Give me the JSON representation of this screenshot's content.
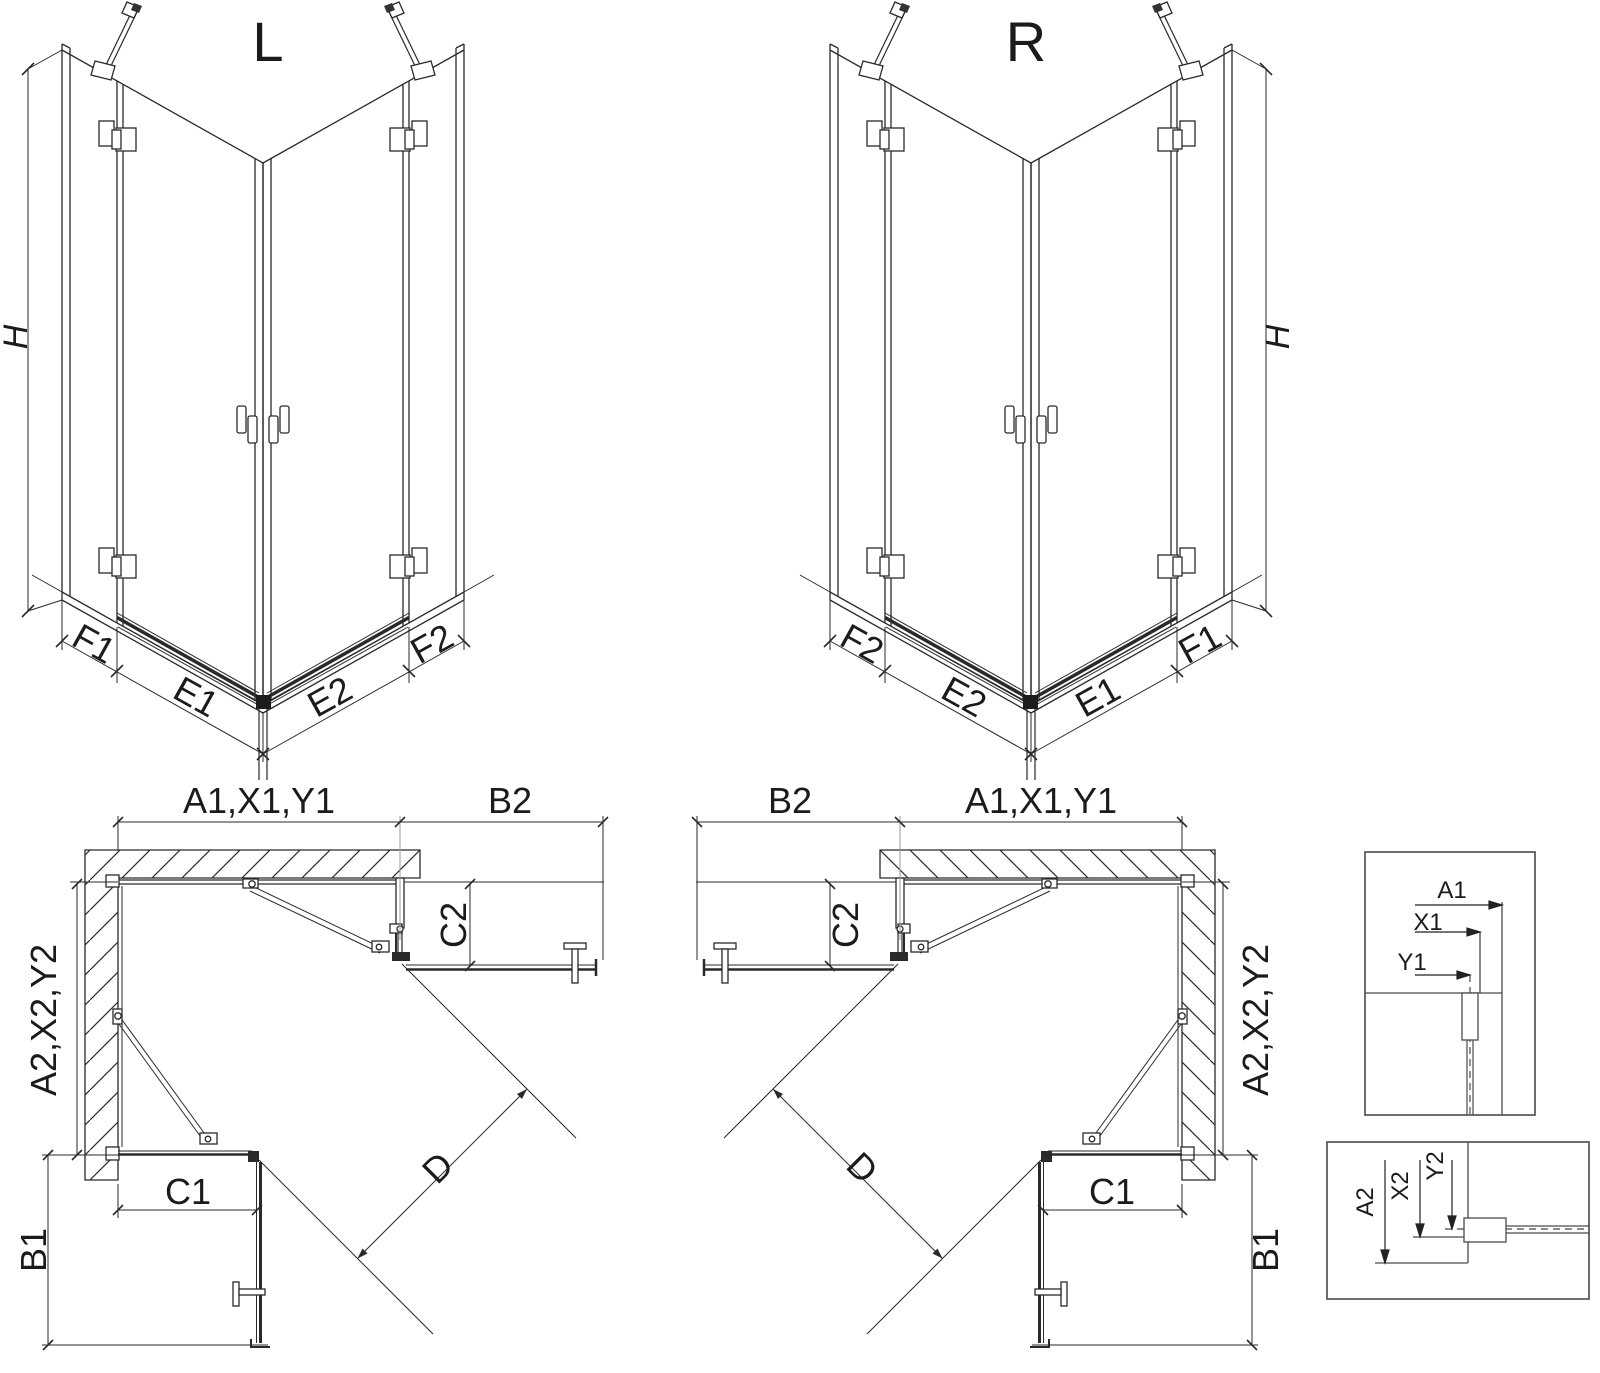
{
  "diagram": {
    "iso_left": {
      "title": "L",
      "h_label": "H",
      "f1": "F1",
      "e1": "E1",
      "e2": "E2",
      "f2": "F2"
    },
    "iso_right": {
      "title": "R",
      "h_label": "H",
      "f1": "F1",
      "e1": "E1",
      "e2": "E2",
      "f2": "F2"
    },
    "plan_left": {
      "top_width": "A1,X1,Y1",
      "door_width": "B2",
      "return_top": "C2",
      "side_depth": "A2,X2,Y2",
      "return_bottom": "C1",
      "door_depth": "B1",
      "diagonal": "D"
    },
    "plan_right": {
      "top_width": "A1,X1,Y1",
      "door_width": "B2",
      "return_top": "C2",
      "side_depth": "A2,X2,Y2",
      "return_bottom": "C1",
      "door_depth": "B1",
      "diagonal": "D"
    },
    "detail_width": {
      "a1": "A1",
      "x1": "X1",
      "y1": "Y1"
    },
    "detail_depth": {
      "a2": "A2",
      "x2": "X2",
      "y2": "Y2"
    }
  },
  "colors": {
    "line": "#2a2a2a",
    "extension": "#999999",
    "fill_dark": "#1c1c1c",
    "background": "#ffffff"
  }
}
